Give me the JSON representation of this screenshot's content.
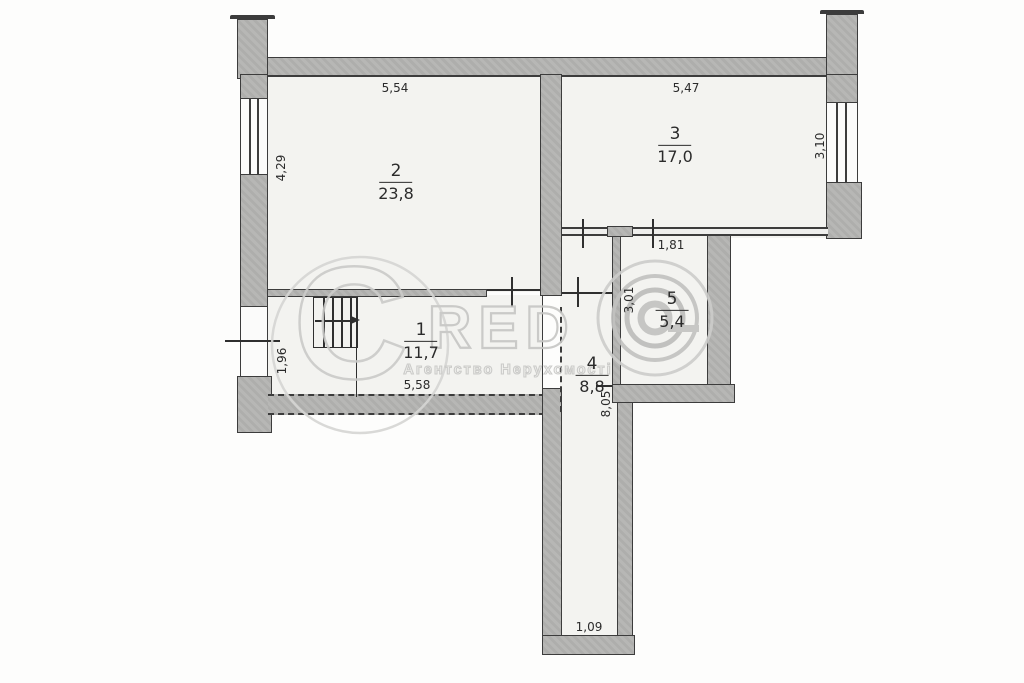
{
  "title": "Apartment floor plan (BTI drawing)",
  "rooms": [
    {
      "number": "1",
      "area": "11,7"
    },
    {
      "number": "2",
      "area": "23,8"
    },
    {
      "number": "3",
      "area": "17,0"
    },
    {
      "number": "4",
      "area": "8,8"
    },
    {
      "number": "5",
      "area": "5,4"
    }
  ],
  "dimensions": {
    "room2_width": "5,54",
    "room3_width": "5,47",
    "room2_height": "4,29",
    "room3_height": "3,10",
    "room1_width": "5,58",
    "room1_height": "1,96",
    "room5_door": "1,81",
    "room5_height": "3,01",
    "corridor_length": "8,05",
    "corridor_width": "1,09"
  },
  "watermark": {
    "letter_c": "C",
    "letters": "RED",
    "agency": "Агентство Нерухомості"
  },
  "colors": {
    "wall_fill": "#b3b3b1",
    "floor_fill": "#f3f3f0",
    "line": "#3c3c3c",
    "watermark": "#c6c6c4"
  }
}
